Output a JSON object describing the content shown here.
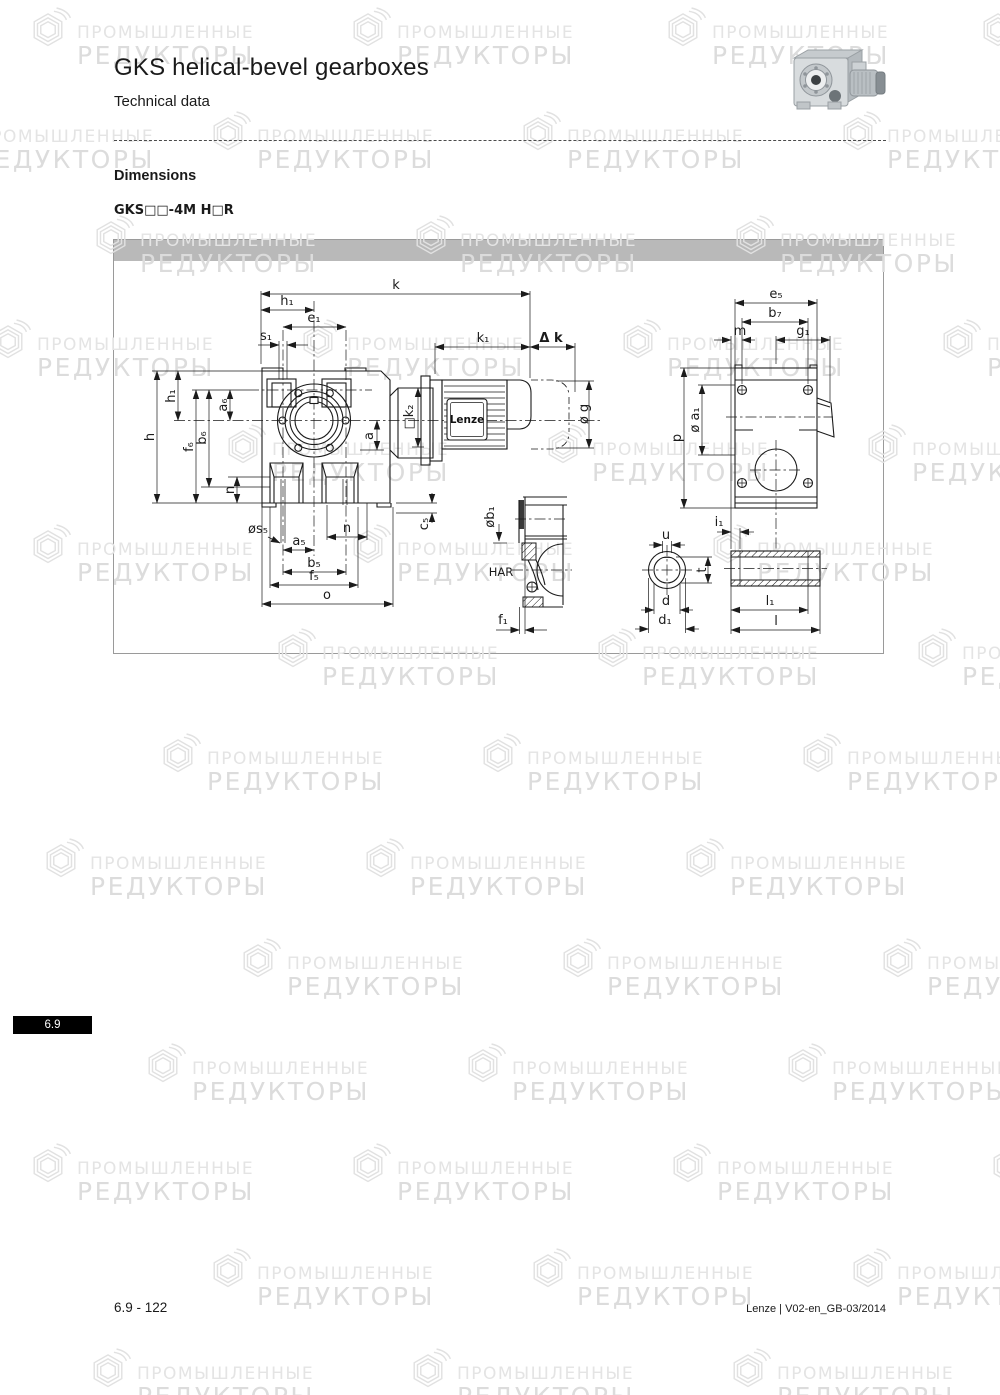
{
  "header": {
    "title": "GKS helical-bevel gearboxes",
    "subtitle": "Technical data",
    "section": "Dimensions",
    "model": "GKS□□-4M H□R"
  },
  "drawing": {
    "brand_plate": "Lenze",
    "labels": {
      "k": "k",
      "h1_top": "h₁",
      "e1": "e₁",
      "s1": "s₁",
      "k1": "k₁",
      "delta_k": "Δ k",
      "h1_left": "h₁",
      "h": "h",
      "f6": "f₆",
      "b6": "b₆",
      "a6": "a₆",
      "n_left": "n",
      "s5": "øs₅",
      "a5": "a₅",
      "b5": "b₅",
      "f5": "f₅",
      "o": "o",
      "n_bottom": "n",
      "c5": "c₅",
      "a": "a",
      "k2": "□k₂",
      "g": "ø g",
      "e5": "e₅",
      "b7": "b₇",
      "m": "m",
      "g1": "g₁",
      "p": "p",
      "a1": "ø a₁",
      "i1": "i₁",
      "har": "HAR",
      "b1": "øb₁",
      "f1": "f₁",
      "u": "u",
      "t": "t",
      "d": "d",
      "d1": "d₁",
      "l1": "l₁",
      "l": "l"
    }
  },
  "sidebar_badge": {
    "label": "6.9"
  },
  "footer": {
    "page": "6.9 - 122",
    "doc": "Lenze | V02-en_GB-03/2014"
  },
  "watermark": {
    "line1": "ПРОМЫШЛЕННЫЕ",
    "line2": "РЕДУКТОРЫ"
  }
}
